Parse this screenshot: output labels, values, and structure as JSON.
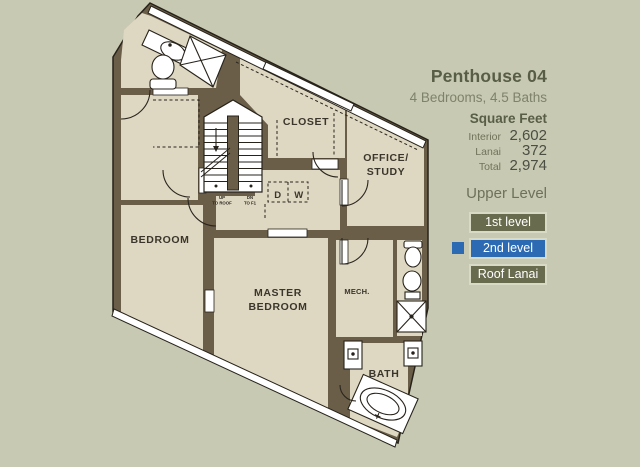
{
  "palette": {
    "background": "#c7c9b2",
    "wall_brown": "#6b5e48",
    "floor_beige": "#ded7c2",
    "accent_blue": "#2c6bb3",
    "button_olive": "#696b4e",
    "heading_text": "#585d45",
    "label_text": "#70735a",
    "number_text": "#4b4e42",
    "plan_text": "#3a362b"
  },
  "sidebar": {
    "title": "Penthouse 04",
    "subtitle": "4 Bedrooms, 4.5 Baths",
    "square_feet_heading": "Square Feet",
    "stats": [
      {
        "label": "Interior",
        "value": "2,602"
      },
      {
        "label": "Lanai",
        "value": "372"
      },
      {
        "label": "Total",
        "value": "2,974"
      }
    ],
    "level_label": "Upper Level",
    "buttons": [
      {
        "label": "1st level",
        "active": false
      },
      {
        "label": "2nd level",
        "active": true
      },
      {
        "label": "Roof Lanai",
        "active": false
      }
    ],
    "active_button": "2nd level"
  },
  "floorplan": {
    "labels": {
      "bedroom": "BEDROOM",
      "master1": "MASTER",
      "master2": "BEDROOM",
      "closet": "CLOSET",
      "office1": "OFFICE/",
      "office2": "STUDY",
      "mech": "MECH.",
      "bath": "BATH",
      "dryer": "D",
      "washer": "W",
      "up1": "UP",
      "up2": "TO ROOF",
      "dn1": "DN",
      "dn2": "TO F1"
    }
  }
}
